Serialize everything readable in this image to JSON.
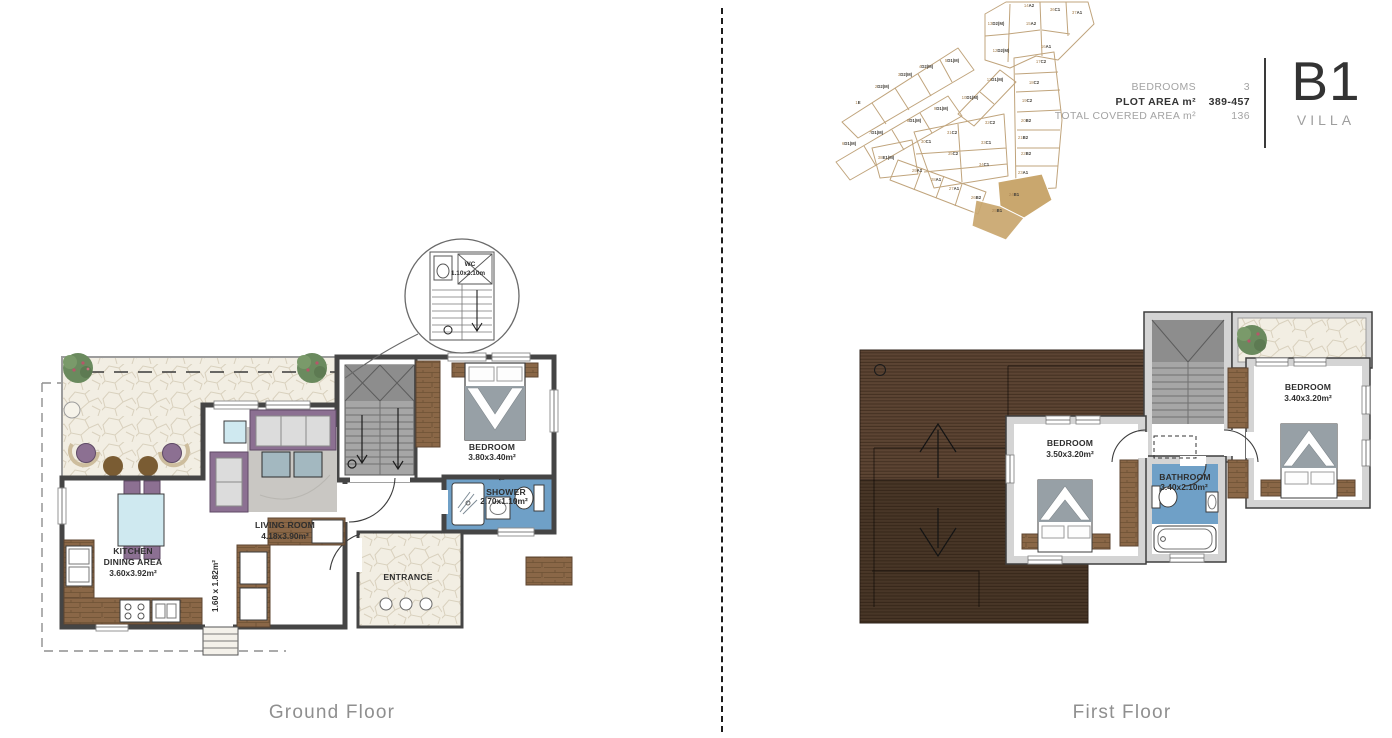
{
  "header": {
    "specs": [
      {
        "label": "BEDROOMS",
        "value": "3"
      },
      {
        "label": "PLOT AREA m²",
        "value": "389-457"
      },
      {
        "label": "TOTAL COVERED AREA m²",
        "value": "136"
      }
    ],
    "unit_code": "B1",
    "unit_type": "VILLA"
  },
  "site_plan": {
    "plots": [
      "1E",
      "2D2(M)",
      "3D2(M)",
      "4D2(M)",
      "5D1(M)",
      "6D1(M)",
      "7D1(M)",
      "8D1(M)",
      "9D1(M)",
      "10D1(M)",
      "11D1(M)",
      "12D2(M)",
      "13D2(M)",
      "14A2",
      "15A2",
      "16A1",
      "17C2",
      "18C2",
      "19C2",
      "20B2",
      "21B2",
      "22B2",
      "23A1",
      "24B1",
      "25B1",
      "26B2",
      "27A1",
      "28A1",
      "29A1",
      "30C1",
      "31C2",
      "32C2",
      "33C1",
      "34C1",
      "35C2",
      "36C1",
      "37A1",
      "38E1(M)"
    ],
    "highlighted_plots": [
      "24B1",
      "25B1"
    ],
    "colors": {
      "boundary": "#c0a47c",
      "highlight_fill": "#c9a76e",
      "label_number": "#ab8655",
      "label_code": "#45413a"
    }
  },
  "ground_floor": {
    "title": "Ground Floor",
    "rooms": {
      "kitchen": {
        "line1": "KITCHEN",
        "line2": "DINING AREA",
        "dims": "3.60x3.92m²"
      },
      "living": {
        "name": "LIVING ROOM",
        "dims": "4.18x3.90m²"
      },
      "bedroom": {
        "name": "BEDROOM",
        "dims": "3.80x3.40m²"
      },
      "shower": {
        "name": "SHOWER",
        "dims": "2.70x1.10m²"
      },
      "entrance": {
        "name": "ENTRANCE"
      },
      "hall": {
        "dims": "1.60 x 1.82m²"
      },
      "wc_callout": {
        "name": "WC",
        "dims": "1.10x2.10m"
      }
    }
  },
  "first_floor": {
    "title": "First Floor",
    "rooms": {
      "bedroom1": {
        "name": "BEDROOM",
        "dims": "3.50x3.20m²"
      },
      "bedroom2": {
        "name": "BEDROOM",
        "dims": "3.40x3.20m²"
      },
      "bathroom": {
        "name": "BATHROOM",
        "dims": "3.40x2.10m²"
      }
    }
  },
  "colors": {
    "wall_dark": "#3f3f3f",
    "wall_light": "#d4d4d4",
    "stair_gray": "#a6a6a6",
    "stone": "#f2eee3",
    "deck_wood": "#523d2e",
    "cabinet_wood": "#8a6747",
    "bath_floor": "#6fa0c7",
    "furniture_purple": "#8c7092",
    "rug_gray": "#c9c7c3",
    "table_blue": "#cfe9f0"
  }
}
